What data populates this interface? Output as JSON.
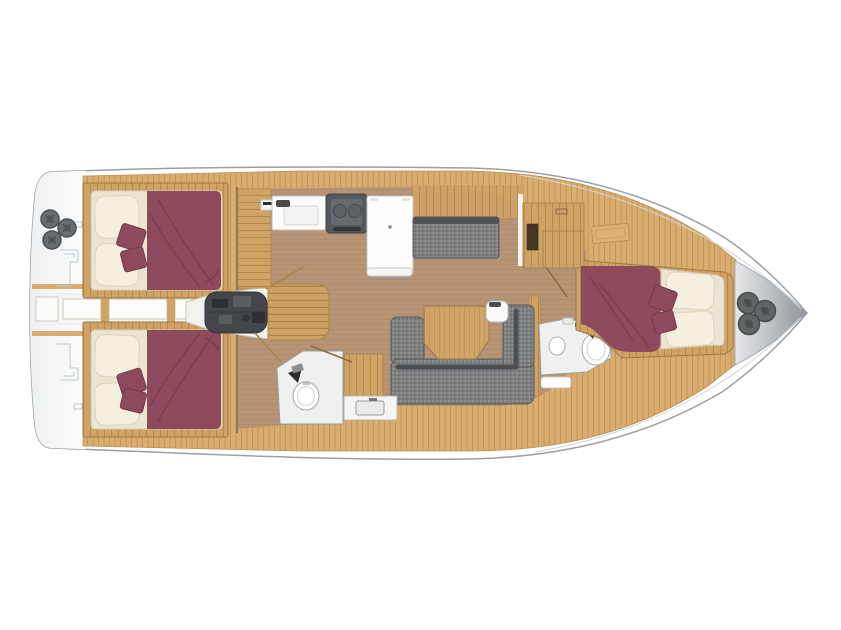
{
  "diagram": {
    "type": "sailing-yacht-interior-floor-plan",
    "orientation": "bow-right",
    "description": "Top-down layout plan of a sailing yacht: three double cabins, two heads, galley, salon with U-sofa and table, engine compartment under companionway, anchor locker at bow, winches on stern platform.",
    "rooms": [
      {
        "id": "stern-platform",
        "label": "Stern platform with winches"
      },
      {
        "id": "aft-cabin-port",
        "label": "Aft double cabin (port)"
      },
      {
        "id": "aft-cabin-starboard",
        "label": "Aft double cabin (starboard)"
      },
      {
        "id": "center-walkway",
        "label": "Centerline walkway between aft cabins"
      },
      {
        "id": "engine-compartment",
        "label": "Engine compartment under companionway"
      },
      {
        "id": "companionway",
        "label": "Companionway steps"
      },
      {
        "id": "galley",
        "label": "Galley with sink, stove and refrigerator"
      },
      {
        "id": "settee-bench",
        "label": "Straight settee bench (port)"
      },
      {
        "id": "salon",
        "label": "Salon with U-shaped sofa and wood table"
      },
      {
        "id": "aft-head",
        "label": "Aft head with toilet and washbasin"
      },
      {
        "id": "wardrobe",
        "label": "Wardrobe at salon forward bulkhead"
      },
      {
        "id": "forward-head",
        "label": "Forward head with toilet and washbasin"
      },
      {
        "id": "forward-cabin",
        "label": "Forward double cabin"
      },
      {
        "id": "anchor-locker",
        "label": "Bow anchor locker with deck fittings"
      }
    ],
    "counts": {
      "winches_stern": 3,
      "bow_fittings": 3,
      "cabins": 3,
      "heads": 2,
      "beds": 3,
      "pillows_per_bed": 2,
      "accent_cushions_per_bed": 2
    }
  },
  "colors": {
    "background": "#ffffff",
    "hull_outline": "#9aa0a5",
    "deck_wood": "#d9ad70",
    "deck_wood_line": "#c2924f",
    "cabinet_wood": "#cfa265",
    "cabinet_wood_line": "#b5884c",
    "floor_wood": "#b79475",
    "floor_wood_line": "#ad8a6a",
    "bed_maroon": "#8d4a5c",
    "bed_maroon_dark": "#76394b",
    "mattress_cream": "#ebe4d2",
    "pillow_white": "#f4efdf",
    "sofa_gray": "#7f8183",
    "sofa_gray_light": "#8b8d8f",
    "sofa_gray_shade": "#717375",
    "sofa_gray_dark": "#515356",
    "engine_dark": "#43474b",
    "metal_light": "#e6e7e9",
    "metal_dark": "#8e9398",
    "fixture_white": "#f4f5f4",
    "room_white": "#eff1f0"
  }
}
